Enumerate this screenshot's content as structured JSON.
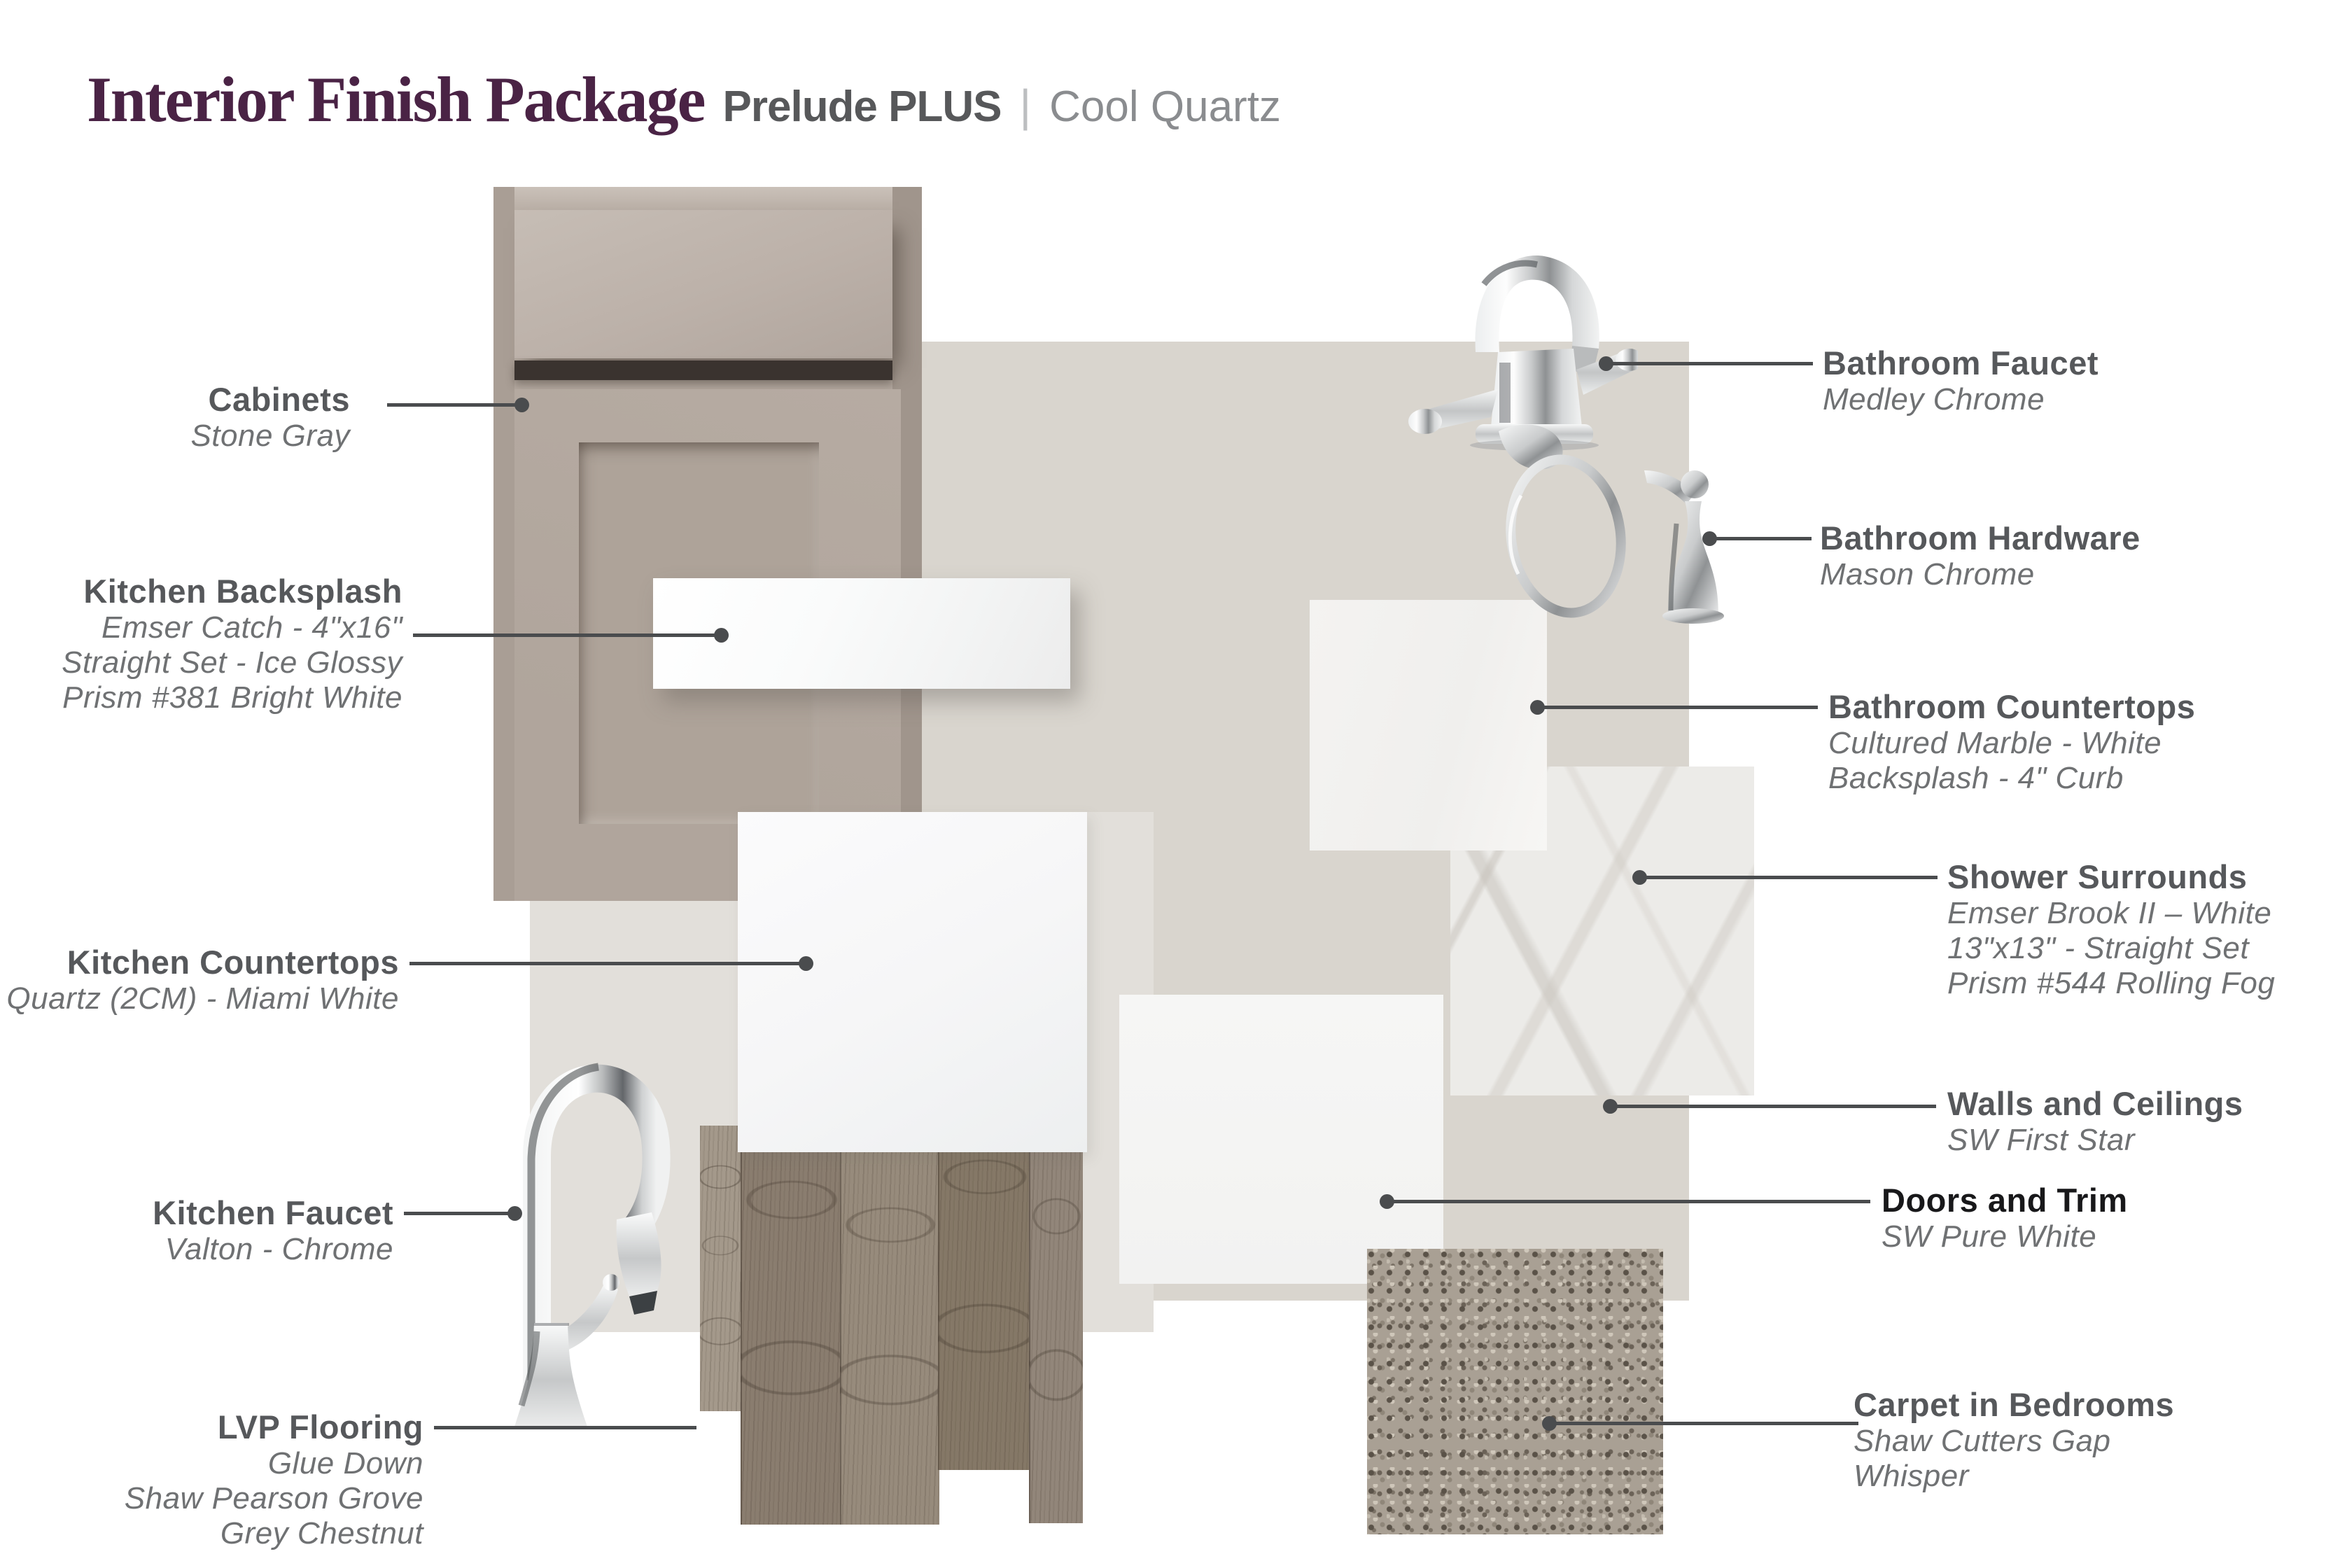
{
  "header": {
    "title": "Interior Finish Package",
    "package": "Prelude PLUS",
    "separator": "|",
    "variant": "Cool Quartz"
  },
  "items": {
    "cabinets": {
      "label": "Cabinets",
      "lines": [
        "Stone Gray"
      ]
    },
    "kitchen_backsplash": {
      "label": "Kitchen Backsplash",
      "lines": [
        "Emser Catch - 4\"x16\"",
        "Straight Set - Ice Glossy",
        "Prism #381 Bright White"
      ]
    },
    "kitchen_countertops": {
      "label": "Kitchen Countertops",
      "lines": [
        "Quartz (2CM)  - Miami White"
      ]
    },
    "kitchen_faucet": {
      "label": "Kitchen Faucet",
      "lines": [
        "Valton - Chrome"
      ]
    },
    "lvp_flooring": {
      "label": "LVP Flooring",
      "lines": [
        "Glue Down",
        "Shaw Pearson Grove",
        "Grey Chestnut"
      ]
    },
    "bathroom_faucet": {
      "label": "Bathroom Faucet",
      "lines": [
        "Medley Chrome"
      ]
    },
    "bathroom_hardware": {
      "label": "Bathroom Hardware",
      "lines": [
        "Mason Chrome"
      ]
    },
    "bathroom_countertops": {
      "label": "Bathroom Countertops",
      "lines": [
        "Cultured Marble - White",
        "Backsplash - 4\" Curb"
      ]
    },
    "shower_surrounds": {
      "label": "Shower Surrounds",
      "lines": [
        "Emser Brook II – White",
        "13\"x13\" - Straight Set",
        "Prism #544 Rolling Fog"
      ]
    },
    "walls_and_ceilings": {
      "label": "Walls and Ceilings",
      "lines": [
        "SW First Star"
      ]
    },
    "doors_and_trim": {
      "label": "Doors and Trim",
      "lines": [
        "SW Pure White"
      ]
    },
    "carpet_in_bedrooms": {
      "label": "Carpet in Bedrooms",
      "lines": [
        "Shaw Cutters Gap",
        "Whisper"
      ]
    }
  },
  "colors": {
    "title_serif": "#4a2345",
    "label_title": "#56585b",
    "label_sub": "#6f7173",
    "leader_line": "#4a4c4e",
    "wall_swatch": "#d9d5ce",
    "wall_swatch_light": "#e2dfda",
    "cabinet_stone_gray": "#b3a89f",
    "wood_grey_chestnut": "#8a7d6f",
    "carpet_whisper": "#a9a094"
  }
}
